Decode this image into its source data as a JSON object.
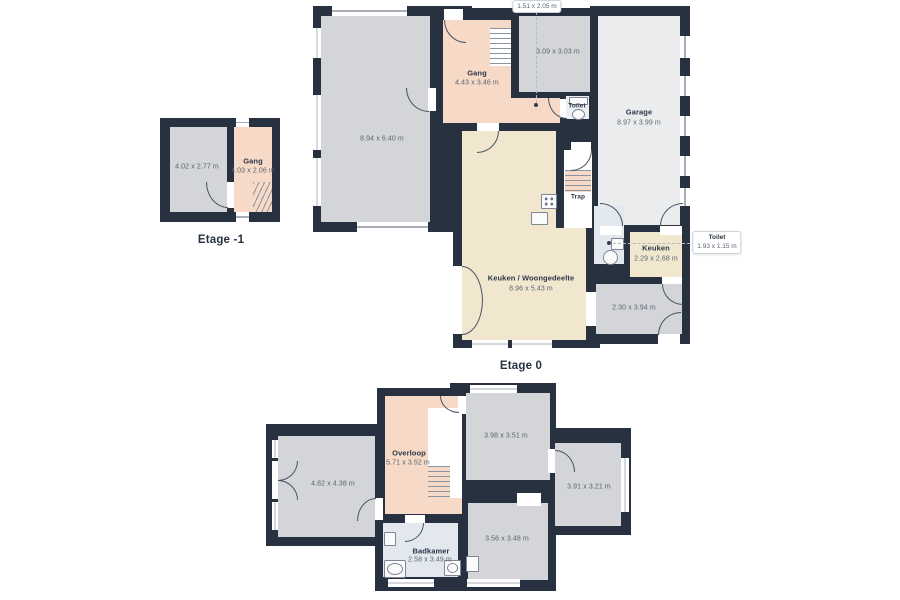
{
  "palette": {
    "wall": "#273140",
    "room_gray": "#d3d5d8",
    "room_light": "#eaecee",
    "room_salmon": "#f6d9c6",
    "room_cream": "#f1e7cf",
    "room_bath": "#e3e8ef",
    "name_text": "#2d3748",
    "dim_text": "#5a6472"
  },
  "floors": {
    "m1": {
      "label": "Etage -1",
      "rooms": {
        "kelder": {
          "dims": "4.02 x 2.77 m"
        },
        "gang": {
          "name": "Gang",
          "dims": "4.03 x 2.06 m"
        }
      }
    },
    "e0": {
      "label": "Etage 0",
      "rooms": {
        "living": {
          "dims": "8.94 x 6.40 m"
        },
        "gang": {
          "name": "Gang",
          "dims": "4.43 x 3.46 m"
        },
        "kamer309": {
          "dims": "3.09 x 3.03 m"
        },
        "toilet_boven": {
          "name": "Toilet"
        },
        "garage": {
          "name": "Garage",
          "dims": "8.97 x 3.99 m"
        },
        "trap": {
          "name": "Trap"
        },
        "keuken_woon": {
          "name": "Keuken / Woongedeelte",
          "dims": "8.96 x 5.43 m"
        },
        "keuken": {
          "name": "Keuken",
          "dims": "2.29 x 2.68 m"
        },
        "berging": {
          "dims": "2.30 x 3.94 m"
        }
      },
      "callouts": {
        "vestibule": {
          "dims": "1.51 x 2.05 m"
        },
        "toilet": {
          "name": "Toilet",
          "dims": "1.93 x 1.15 m"
        }
      }
    },
    "e1": {
      "rooms": {
        "kamer_links": {
          "dims": "4.82 x 4.38 m"
        },
        "overloop": {
          "name": "Overloop",
          "dims": "5.71 x 3.52 m"
        },
        "kamer_boven": {
          "dims": "3.98 x 3.51 m"
        },
        "kamer_rechts": {
          "dims": "3.91 x 3.21 m"
        },
        "kamer_midden": {
          "dims": "3.56 x 3.48 m"
        },
        "badkamer": {
          "name": "Badkamer",
          "dims": "2.58 x 3.49 m"
        }
      }
    }
  }
}
